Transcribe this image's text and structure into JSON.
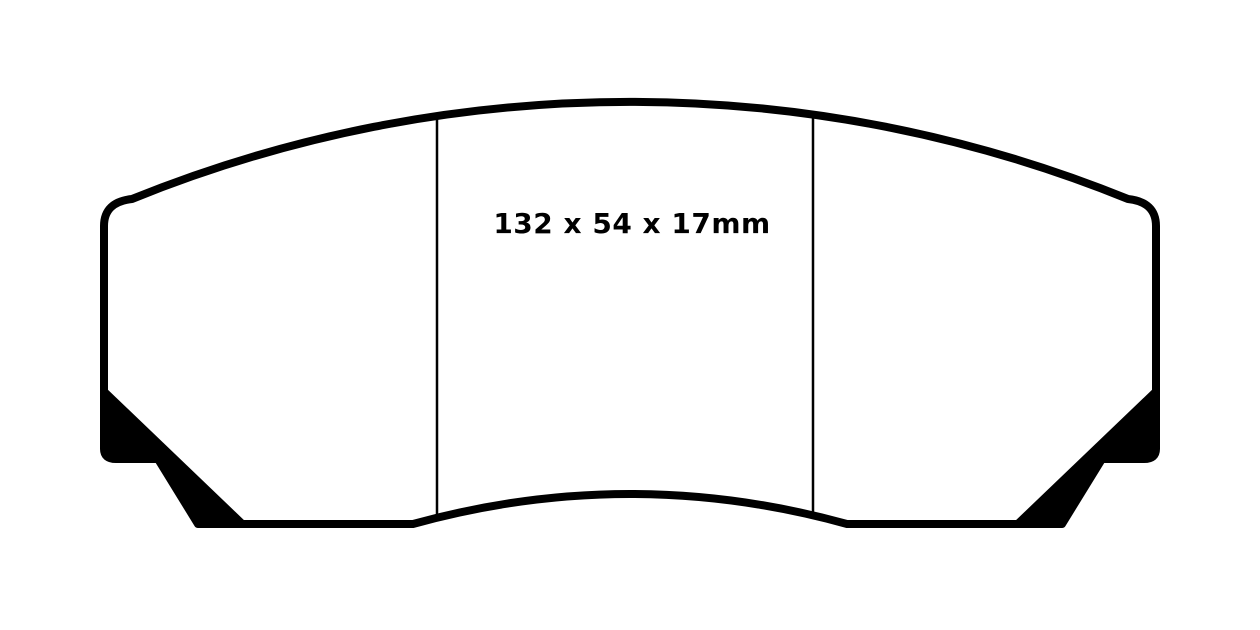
{
  "diagram": {
    "dimensions_label": "132 x 54 x 17mm",
    "dimensions": {
      "width_mm": 132,
      "height_mm": 54,
      "thickness_mm": 17
    },
    "colors": {
      "line": "#000000",
      "background": "#ffffff"
    }
  }
}
